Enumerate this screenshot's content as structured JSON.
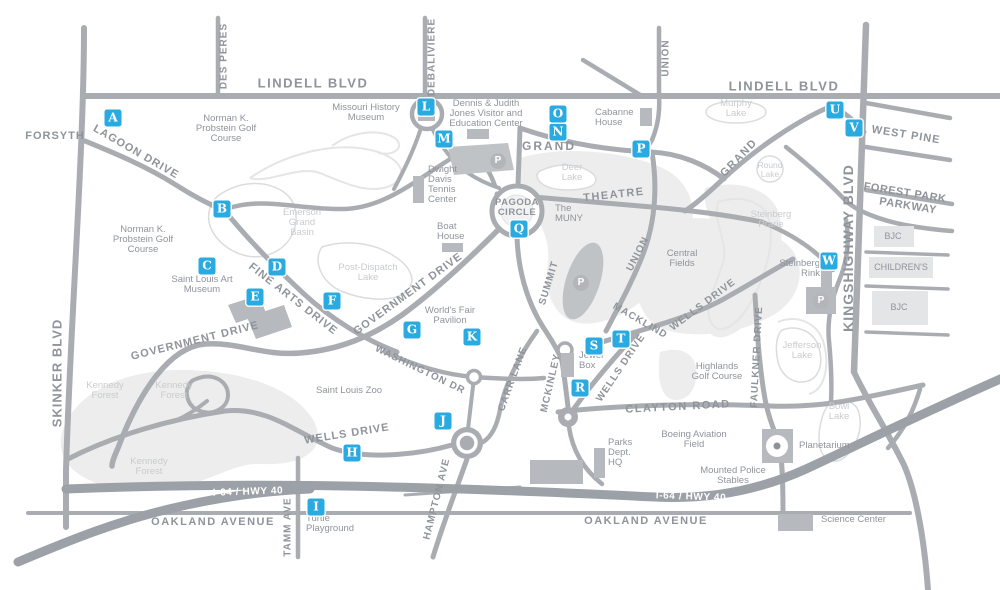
{
  "map": {
    "colors": {
      "marker_blue": "#29abe2",
      "road_gray": "#a9adb2",
      "highway_gray": "#9ba1a7",
      "label_gray": "#8f949b",
      "light_label_gray": "#c9cbce",
      "park_fill": "#ecedec",
      "building_gray": "#b6b9bd"
    },
    "markers": [
      {
        "letter": "A",
        "x": 113,
        "y": 118
      },
      {
        "letter": "B",
        "x": 222,
        "y": 209
      },
      {
        "letter": "C",
        "x": 207,
        "y": 266
      },
      {
        "letter": "D",
        "x": 277,
        "y": 267
      },
      {
        "letter": "E",
        "x": 255,
        "y": 297
      },
      {
        "letter": "F",
        "x": 332,
        "y": 301
      },
      {
        "letter": "G",
        "x": 412,
        "y": 330
      },
      {
        "letter": "H",
        "x": 352,
        "y": 453
      },
      {
        "letter": "I",
        "x": 316,
        "y": 507
      },
      {
        "letter": "J",
        "x": 443,
        "y": 421
      },
      {
        "letter": "K",
        "x": 472,
        "y": 337
      },
      {
        "letter": "L",
        "x": 426,
        "y": 107
      },
      {
        "letter": "M",
        "x": 444,
        "y": 139
      },
      {
        "letter": "N",
        "x": 558,
        "y": 132
      },
      {
        "letter": "O",
        "x": 558,
        "y": 114
      },
      {
        "letter": "P",
        "x": 641,
        "y": 149
      },
      {
        "letter": "Q",
        "x": 519,
        "y": 229
      },
      {
        "letter": "R",
        "x": 580,
        "y": 388
      },
      {
        "letter": "S",
        "x": 594,
        "y": 346
      },
      {
        "letter": "T",
        "x": 621,
        "y": 339
      },
      {
        "letter": "U",
        "x": 835,
        "y": 110
      },
      {
        "letter": "V",
        "x": 854,
        "y": 128
      },
      {
        "letter": "W",
        "x": 829,
        "y": 261
      }
    ],
    "parking_icons": [
      {
        "x": 498,
        "y": 161
      },
      {
        "x": 581,
        "y": 283
      },
      {
        "x": 821,
        "y": 301
      }
    ],
    "road_labels": [
      {
        "text": "LINDELL BLVD",
        "x": 313,
        "y": 83,
        "rot": 0,
        "size": 13,
        "sp": 1.5
      },
      {
        "text": "LINDELL BLVD",
        "x": 784,
        "y": 86,
        "rot": 0,
        "size": 13,
        "sp": 1.5
      },
      {
        "text": "FORSYTH",
        "x": 55,
        "y": 136,
        "rot": 0,
        "size": 11,
        "sp": 1
      },
      {
        "text": "DES PERES",
        "x": 224,
        "y": 56,
        "rot": -90,
        "size": 10,
        "sp": 1
      },
      {
        "text": "DEBALIVIERE",
        "x": 432,
        "y": 57,
        "rot": -90,
        "size": 10,
        "sp": 1
      },
      {
        "text": "UNION",
        "x": 666,
        "y": 58,
        "rot": -90,
        "size": 10,
        "sp": 1
      },
      {
        "text": "UNION",
        "x": 638,
        "y": 254,
        "rot": -63,
        "size": 10,
        "sp": 1
      },
      {
        "text": "KINGSHIGHWAY BLVD",
        "x": 848,
        "y": 248,
        "rot": -90,
        "size": 14,
        "sp": 1
      },
      {
        "text": "SKINKER BLVD",
        "x": 57,
        "y": 373,
        "rot": -90,
        "size": 13,
        "sp": 1
      },
      {
        "text": "WEST PINE",
        "x": 906,
        "y": 135,
        "rot": 9,
        "size": 11,
        "sp": 1
      },
      {
        "text": "FOREST PARK",
        "x": 905,
        "y": 193,
        "rot": 9,
        "size": 11,
        "sp": 0.5
      },
      {
        "text": "PARKWAY",
        "x": 908,
        "y": 206,
        "rot": 9,
        "size": 11,
        "sp": 0.5
      },
      {
        "text": "LAGOON DRIVE",
        "x": 136,
        "y": 152,
        "rot": 30,
        "size": 11,
        "sp": 1
      },
      {
        "text": "GRAND",
        "x": 549,
        "y": 146,
        "rot": 0,
        "size": 12,
        "sp": 2
      },
      {
        "text": "GRAND",
        "x": 739,
        "y": 158,
        "rot": -46,
        "size": 11,
        "sp": 1.5
      },
      {
        "text": "THEATRE",
        "x": 614,
        "y": 195,
        "rot": -6,
        "size": 11,
        "sp": 1.5
      },
      {
        "text": "SUMMIT",
        "x": 549,
        "y": 283,
        "rot": -73,
        "size": 10,
        "sp": 1
      },
      {
        "text": "MACKLIND",
        "x": 640,
        "y": 321,
        "rot": 30,
        "size": 10,
        "sp": 1
      },
      {
        "text": "WELLS DRIVE",
        "x": 703,
        "y": 305,
        "rot": -37,
        "size": 10,
        "sp": 1
      },
      {
        "text": "WELLS DRIVE",
        "x": 621,
        "y": 368,
        "rot": -56,
        "size": 10,
        "sp": 1
      },
      {
        "text": "WELLS DRIVE",
        "x": 347,
        "y": 434,
        "rot": -9,
        "size": 11,
        "sp": 1
      },
      {
        "text": "GOVERNMENT DRIVE",
        "x": 408,
        "y": 294,
        "rot": -36,
        "size": 11,
        "sp": 1
      },
      {
        "text": "GOVERNMENT DRIVE",
        "x": 195,
        "y": 341,
        "rot": -14,
        "size": 11,
        "sp": 1
      },
      {
        "text": "FINE ARTS DRIVE",
        "x": 293,
        "y": 299,
        "rot": 38,
        "size": 11,
        "sp": 1
      },
      {
        "text": "WASHINGTON DR",
        "x": 420,
        "y": 370,
        "rot": 26,
        "size": 10,
        "sp": 1
      },
      {
        "text": "CARR LANE",
        "x": 513,
        "y": 379,
        "rot": -70,
        "size": 10,
        "sp": 1
      },
      {
        "text": "MCKINLEY",
        "x": 551,
        "y": 383,
        "rot": -77,
        "size": 10,
        "sp": 1
      },
      {
        "text": "HAMPTON AVE",
        "x": 437,
        "y": 499,
        "rot": -76,
        "size": 10,
        "sp": 1
      },
      {
        "text": "TAMM AVE",
        "x": 288,
        "y": 527,
        "rot": -90,
        "size": 10,
        "sp": 1
      },
      {
        "text": "CLAYTON ROAD",
        "x": 678,
        "y": 407,
        "rot": -3,
        "size": 11,
        "sp": 1.5
      },
      {
        "text": "FAULKNER DRIVE",
        "x": 757,
        "y": 357,
        "rot": -87,
        "size": 10,
        "sp": 1
      },
      {
        "text": "OAKLAND AVENUE",
        "x": 213,
        "y": 522,
        "rot": 0,
        "size": 11,
        "sp": 1.5
      },
      {
        "text": "OAKLAND AVENUE",
        "x": 646,
        "y": 521,
        "rot": 0,
        "size": 11,
        "sp": 1.5
      }
    ],
    "highway_labels": [
      {
        "text": "I-64 / HWY 40",
        "x": 248,
        "y": 492,
        "rot": -2
      },
      {
        "text": "I-64 / HWY 40",
        "x": 691,
        "y": 497,
        "rot": 2
      }
    ],
    "places": [
      {
        "lines": [
          "Norman K.",
          "Probstein Golf",
          "Course"
        ],
        "x": 226,
        "y": 114
      },
      {
        "lines": [
          "Norman K.",
          "Probstein Golf",
          "Course"
        ],
        "x": 143,
        "y": 225
      },
      {
        "lines": [
          "Missouri History",
          "Museum"
        ],
        "x": 366,
        "y": 103
      },
      {
        "lines": [
          "Dennis & Judith",
          "Jones Visitor and",
          "Education Center"
        ],
        "x": 486,
        "y": 99
      },
      {
        "lines": [
          "Cabanne",
          "House"
        ],
        "x": 595,
        "y": 108,
        "align": "left"
      },
      {
        "lines": [
          "Dwight",
          "Davis",
          "Tennis",
          "Center"
        ],
        "x": 428,
        "y": 165,
        "align": "left"
      },
      {
        "lines": [
          "Boat",
          "House"
        ],
        "x": 437,
        "y": 222,
        "align": "left"
      },
      {
        "lines": [
          "Deer",
          "Lake"
        ],
        "x": 572,
        "y": 163,
        "light": true
      },
      {
        "lines": [
          "The",
          "MUNY"
        ],
        "x": 555,
        "y": 204,
        "align": "left"
      },
      {
        "lines": [
          "PAGODA",
          "CIRCLE"
        ],
        "x": 517,
        "y": 198,
        "size": 9.5,
        "bold": true
      },
      {
        "lines": [
          "Central",
          "Fields"
        ],
        "x": 682,
        "y": 249
      },
      {
        "lines": [
          "Steinberg",
          "Prarie"
        ],
        "x": 771,
        "y": 210,
        "light": true
      },
      {
        "lines": [
          "Steinberg",
          "Rink"
        ],
        "x": 820,
        "y": 259,
        "align": "right"
      },
      {
        "lines": [
          "Murphy",
          "Lake"
        ],
        "x": 736,
        "y": 99,
        "light": true
      },
      {
        "lines": [
          "Round",
          "Lake"
        ],
        "x": 770,
        "y": 161,
        "light": true,
        "size": 8.5
      },
      {
        "lines": [
          "Emerson",
          "Grand",
          "Basin"
        ],
        "x": 302,
        "y": 208,
        "light": true
      },
      {
        "lines": [
          "Post-Dispatch",
          "Lake"
        ],
        "x": 368,
        "y": 263,
        "light": true
      },
      {
        "lines": [
          "Saint Louis Art",
          "Museum"
        ],
        "x": 202,
        "y": 275
      },
      {
        "lines": [
          "World's Fair",
          "Pavilion"
        ],
        "x": 450,
        "y": 306
      },
      {
        "lines": [
          "Jefferson",
          "Lake"
        ],
        "x": 802,
        "y": 341,
        "light": true
      },
      {
        "lines": [
          "Highlands",
          "Golf Course"
        ],
        "x": 717,
        "y": 362
      },
      {
        "lines": [
          "Kennedy",
          "Forest"
        ],
        "x": 105,
        "y": 381,
        "light": true
      },
      {
        "lines": [
          "Kennedy",
          "Forest"
        ],
        "x": 174,
        "y": 381,
        "light": true
      },
      {
        "lines": [
          "Kennedy",
          "Forest"
        ],
        "x": 149,
        "y": 457,
        "light": true
      },
      {
        "lines": [
          "Saint Louis Zoo"
        ],
        "x": 349,
        "y": 386
      },
      {
        "lines": [
          "Jewel",
          "Box"
        ],
        "x": 579,
        "y": 351,
        "align": "left"
      },
      {
        "lines": [
          "Parks",
          "Dept.",
          "HQ"
        ],
        "x": 608,
        "y": 438,
        "align": "left"
      },
      {
        "lines": [
          "Boeing Aviation",
          "Field"
        ],
        "x": 694,
        "y": 430
      },
      {
        "lines": [
          "Mounted Police",
          "Stables"
        ],
        "x": 733,
        "y": 466
      },
      {
        "lines": [
          "Planetarium"
        ],
        "x": 799,
        "y": 441,
        "align": "left"
      },
      {
        "lines": [
          "Bowl",
          "Lake"
        ],
        "x": 839,
        "y": 402,
        "light": true
      },
      {
        "lines": [
          "Turtle",
          "Playground"
        ],
        "x": 306,
        "y": 514,
        "align": "left"
      },
      {
        "lines": [
          "Science Center"
        ],
        "x": 821,
        "y": 515,
        "align": "left"
      },
      {
        "lines": [
          "BJC"
        ],
        "x": 893,
        "y": 232,
        "size": 9
      },
      {
        "lines": [
          "CHILDREN'S"
        ],
        "x": 901,
        "y": 263,
        "size": 9
      },
      {
        "lines": [
          "BJC"
        ],
        "x": 899,
        "y": 303,
        "size": 9
      }
    ]
  }
}
